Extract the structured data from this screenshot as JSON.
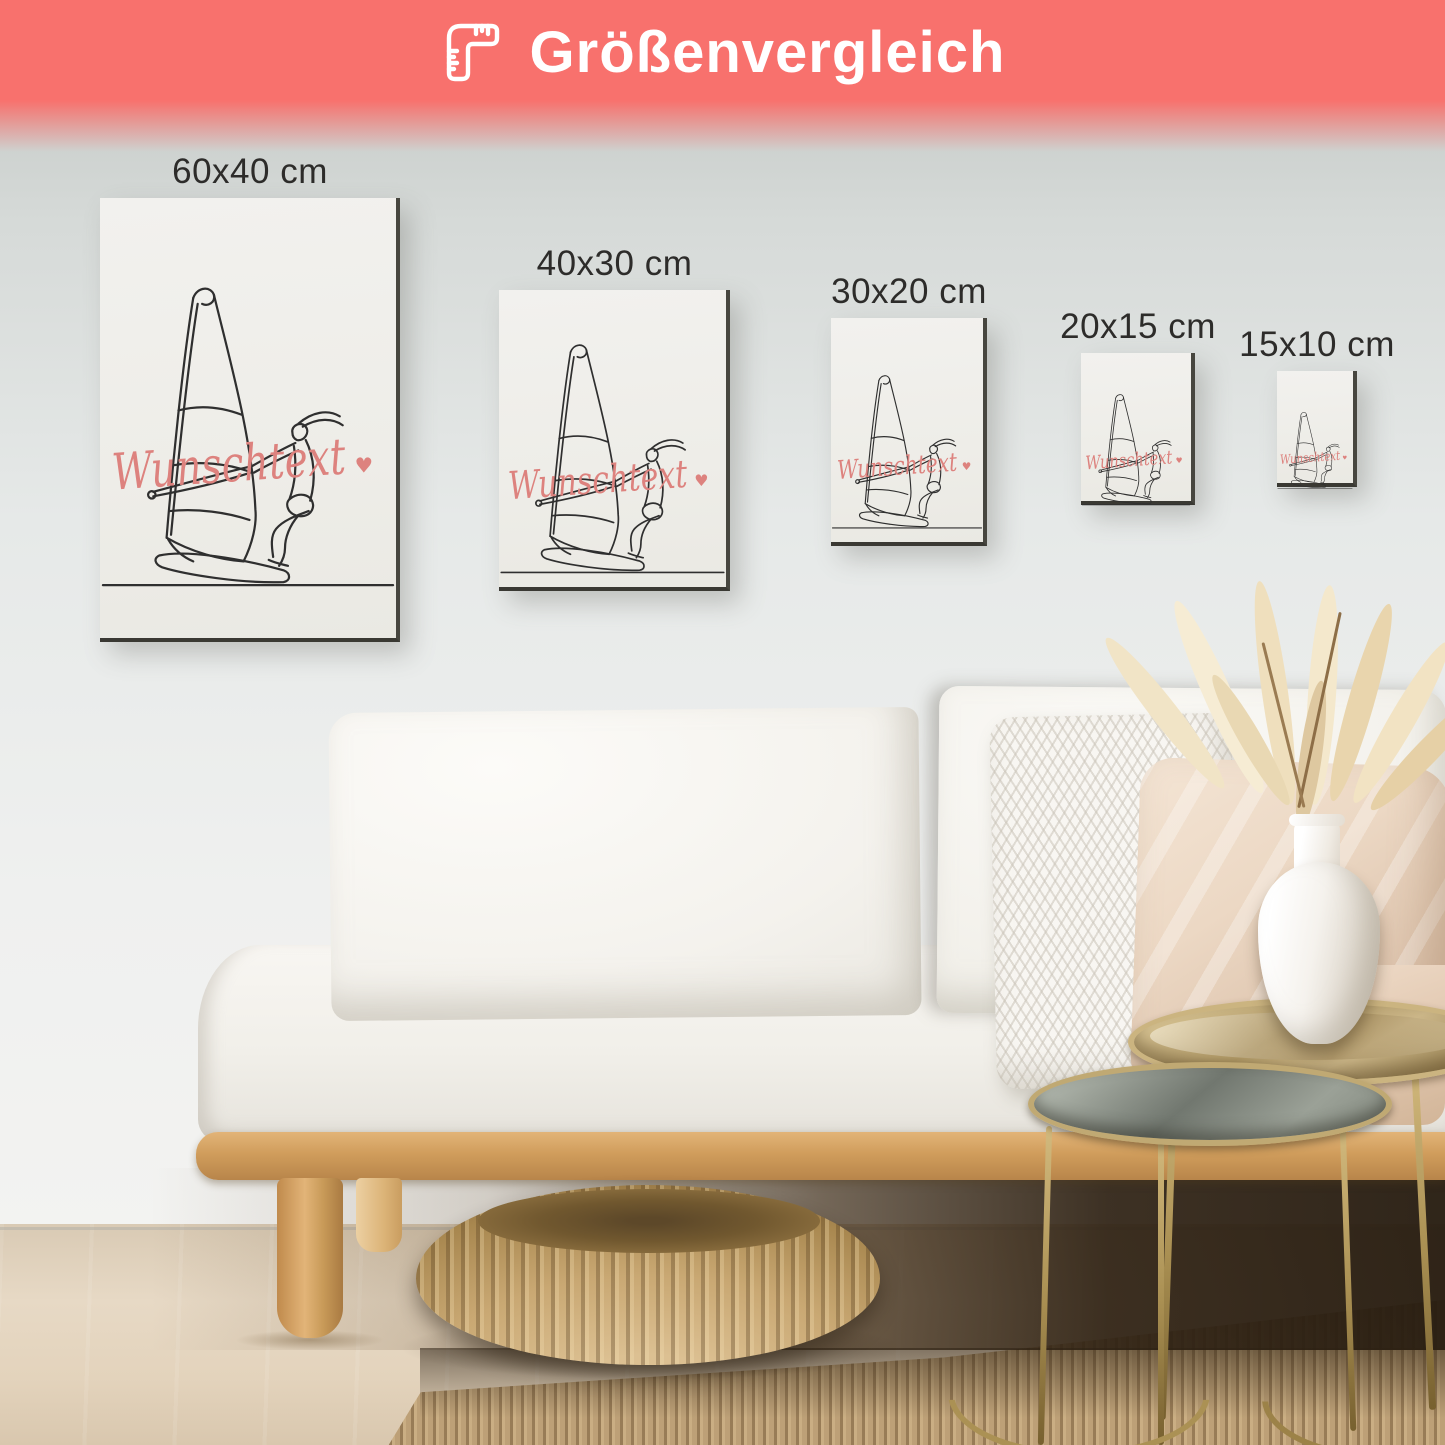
{
  "banner": {
    "title": "Größenvergleich",
    "icon": "corner-ruler-icon",
    "background_color": "#f8716d",
    "text_color": "#ffffff"
  },
  "size_labels": [
    {
      "label": "60x40 cm"
    },
    {
      "label": "40x30 cm"
    },
    {
      "label": "30x20 cm"
    },
    {
      "label": "20x15 cm"
    },
    {
      "label": "15x10 cm"
    }
  ],
  "artwork": {
    "subject": "windsurfer-single-line-art",
    "custom_text": "Wunschtext",
    "heart_symbol": "♥",
    "text_color": "#dd827e",
    "line_color": "#2f2f2f"
  },
  "scene": {
    "wall_color_top": "#c6cbc8",
    "wall_color_bottom": "#f3f3f1",
    "canvas_color": "#f0efeb",
    "label_color": "#2d2c2a",
    "sofa_color": "#f4f2ee",
    "wood_color": "#d09d5c",
    "pouf_color": "#c9a873",
    "rug_color": "#bda077",
    "floor_color": "#e3d5c1",
    "table_gold_color": "#b49a5f"
  }
}
